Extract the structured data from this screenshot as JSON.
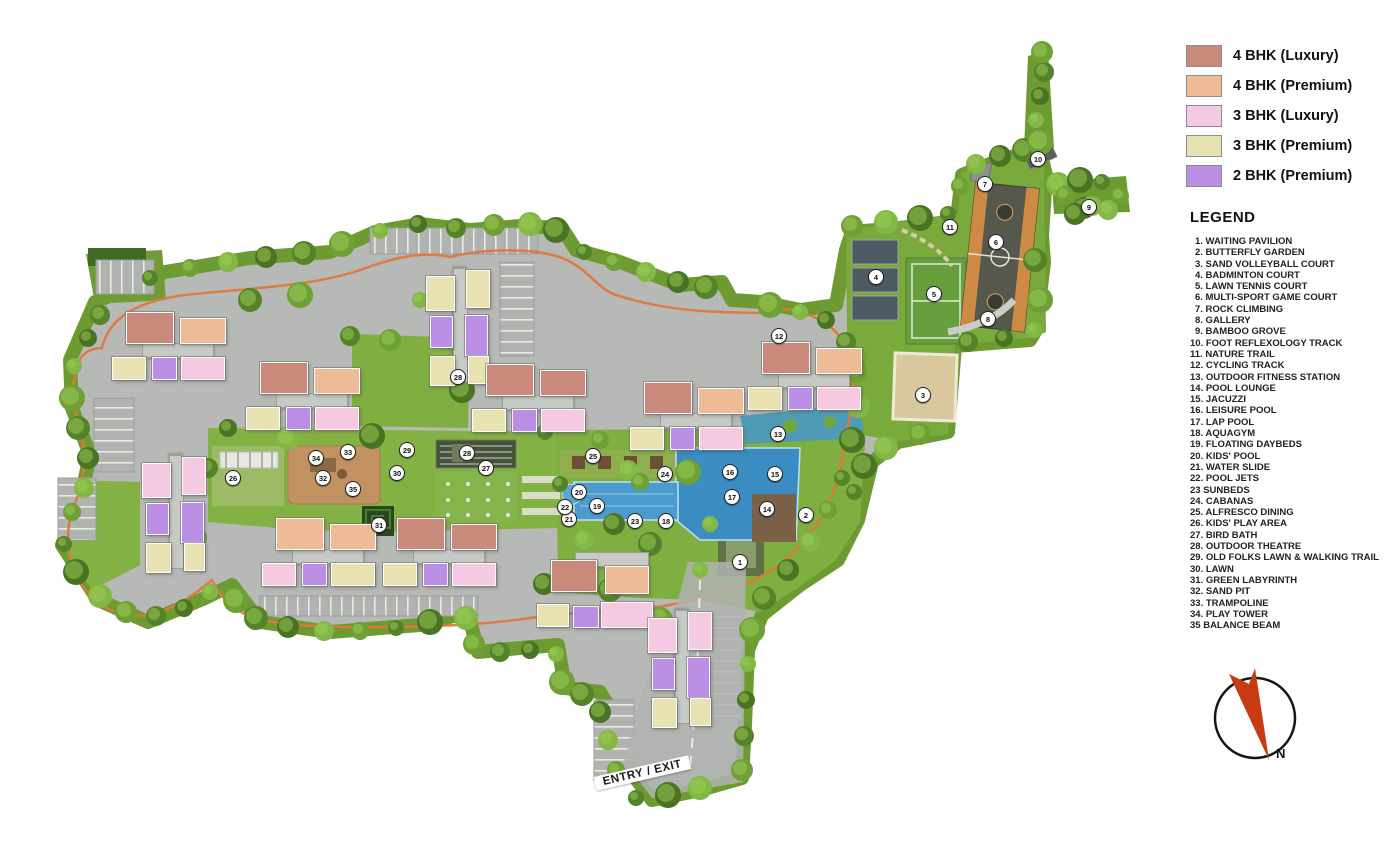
{
  "unit_legend": {
    "items": [
      {
        "label": "4 BHK (Luxury)",
        "color": "#c9897b"
      },
      {
        "label": "4 BHK (Premium)",
        "color": "#edbb95"
      },
      {
        "label": "3 BHK (Luxury)",
        "color": "#f4c9e1"
      },
      {
        "label": "3 BHK (Premium)",
        "color": "#e8e2b2"
      },
      {
        "label": "2 BHK (Premium)",
        "color": "#bb8fe5"
      }
    ]
  },
  "legend": {
    "title": "LEGEND",
    "items": [
      "1. WAITING PAVILION",
      "2. BUTTERFLY GARDEN",
      "3. SAND VOLLEYBALL COURT",
      "4. BADMINTON COURT",
      "5. LAWN TENNIS COURT",
      "6. MULTI-SPORT GAME COURT",
      "7. ROCK CLIMBING",
      "8. GALLERY",
      "9. BAMBOO GROVE",
      "10. FOOT REFLEXOLOGY TRACK",
      "11. NATURE TRAIL",
      "12. CYCLING TRACK",
      "13. OUTDOOR FITNESS STATION",
      "14. POOL LOUNGE",
      "15. JACUZZI",
      "16. LEISURE POOL",
      "17. LAP POOL",
      "18. AQUAGYM",
      "19. FLOATING DAYBEDS",
      "20. KIDS' POOL",
      "21. WATER SLIDE",
      "22. POOL JETS",
      "23 SUNBEDS",
      "24. CABANAS",
      "25. ALFRESCO DINING",
      "26. KIDS' PLAY AREA",
      "27. BIRD BATH",
      "28. OUTDOOR THEATRE",
      "29. OLD FOLKS LAWN & WALKING TRAIL",
      "30. LAWN",
      "31. GREEN LABYRINTH",
      "32. SAND PIT",
      "33. TRAMPOLINE",
      "34. PLAY TOWER",
      "35 BALANCE BEAM"
    ]
  },
  "compass": {
    "label": "N"
  },
  "entry_exit_label": "ENTRY / EXIT",
  "colors": {
    "road": "#b6b9b5",
    "lawn": "#84b143",
    "pool": "#3a8cc3",
    "trail": "#e0763c",
    "compass_arrow": "#c63c10"
  },
  "towers": [
    {
      "id": "tower-6",
      "name": "TOWER 6",
      "type": "h",
      "x": 112,
      "y": 312,
      "blocks": [
        {
          "letter": "A",
          "unit": "4 BHK (Luxury)"
        },
        {
          "letter": "B",
          "unit": "4 BHK (Premium)"
        },
        {
          "letter": "E",
          "unit": "3 BHK (Premium)"
        },
        {
          "letter": "D",
          "unit": "2 BHK (Premium)"
        },
        {
          "letter": "C",
          "unit": "3 BHK (Luxury)"
        }
      ]
    },
    {
      "id": "tower-7",
      "name": "TOWER 7",
      "type": "h",
      "x": 246,
      "y": 362,
      "blocks": [
        {
          "letter": "A",
          "unit": "4 BHK (Luxury)"
        },
        {
          "letter": "B",
          "unit": "4 BHK (Premium)"
        },
        {
          "letter": "E",
          "unit": "3 BHK (Premium)"
        },
        {
          "letter": "D",
          "unit": "2 BHK (Premium)"
        },
        {
          "letter": "C",
          "unit": "3 BHK (Luxury)"
        }
      ]
    },
    {
      "id": "tower-8",
      "name": "TOWER 8",
      "type": "v",
      "x": 426,
      "y": 268,
      "blocks": [
        {
          "letter": "F",
          "unit": "3 BHK (Premium)"
        },
        {
          "letter": "A",
          "unit": "3 BHK (Premium)"
        },
        {
          "letter": "E",
          "unit": "2 BHK (Premium)"
        },
        {
          "letter": "B",
          "unit": "2 BHK (Premium)"
        },
        {
          "letter": "D",
          "unit": "3 BHK (Premium)"
        },
        {
          "letter": "C",
          "unit": "3 BHK (Premium)"
        }
      ]
    },
    {
      "id": "tower-9",
      "name": "TOWER 9",
      "type": "h",
      "x": 472,
      "y": 364,
      "blocks": [
        {
          "letter": "A",
          "unit": "4 BHK (Luxury)"
        },
        {
          "letter": "B",
          "unit": "4 BHK (Luxury)"
        },
        {
          "letter": "E",
          "unit": "3 BHK (Premium)"
        },
        {
          "letter": "D",
          "unit": "2 BHK (Premium)"
        },
        {
          "letter": "C",
          "unit": "3 BHK (Luxury)"
        }
      ]
    },
    {
      "id": "tower-10",
      "name": "TOWER 10",
      "type": "h",
      "x": 630,
      "y": 382,
      "blocks": [
        {
          "letter": "A",
          "unit": "4 BHK (Luxury)"
        },
        {
          "letter": "B",
          "unit": "4 BHK (Premium)"
        },
        {
          "letter": "E",
          "unit": "3 BHK (Premium)"
        },
        {
          "letter": "D",
          "unit": "2 BHK (Premium)"
        },
        {
          "letter": "C",
          "unit": "3 BHK (Luxury)"
        }
      ]
    },
    {
      "id": "tower-11",
      "name": "TOWER 11",
      "type": "h",
      "x": 748,
      "y": 342,
      "blocks": [
        {
          "letter": "A",
          "unit": "4 BHK (Luxury)"
        },
        {
          "letter": "B",
          "unit": "4 BHK (Premium)"
        },
        {
          "letter": "E",
          "unit": "3 BHK (Premium)"
        },
        {
          "letter": "D",
          "unit": "2 BHK (Premium)"
        },
        {
          "letter": "C",
          "unit": "3 BHK (Luxury)"
        }
      ]
    },
    {
      "id": "tower-5",
      "name": "TOWER 5",
      "type": "v",
      "x": 142,
      "y": 455,
      "blocks": [
        {
          "letter": "F",
          "unit": "3 BHK (Luxury)"
        },
        {
          "letter": "A",
          "unit": "3 BHK (Luxury)"
        },
        {
          "letter": "E",
          "unit": "2 BHK (Premium)"
        },
        {
          "letter": "B",
          "unit": "2 BHK (Premium)"
        },
        {
          "letter": "D",
          "unit": "3 BHK (Premium)"
        },
        {
          "letter": "C",
          "unit": "3 BHK (Premium)"
        }
      ]
    },
    {
      "id": "tower-4",
      "name": "TOWER 4",
      "type": "h",
      "x": 262,
      "y": 518,
      "blocks": [
        {
          "letter": "A",
          "unit": "4 BHK (Premium)"
        },
        {
          "letter": "B",
          "unit": "4 BHK (Premium)"
        },
        {
          "letter": "E",
          "unit": "3 BHK (Luxury)"
        },
        {
          "letter": "D",
          "unit": "2 BHK (Premium)"
        },
        {
          "letter": "C",
          "unit": "3 BHK (Premium)"
        }
      ]
    },
    {
      "id": "tower-3",
      "name": "TOWER 3",
      "type": "h",
      "x": 383,
      "y": 518,
      "blocks": [
        {
          "letter": "A",
          "unit": "4 BHK (Luxury)"
        },
        {
          "letter": "B",
          "unit": "4 BHK (Luxury)"
        },
        {
          "letter": "E",
          "unit": "3 BHK (Premium)"
        },
        {
          "letter": "D",
          "unit": "2 BHK (Premium)"
        },
        {
          "letter": "C",
          "unit": "3 BHK (Luxury)"
        }
      ]
    },
    {
      "id": "tower-2",
      "name": "TOWER 2",
      "type": "ht",
      "x": 537,
      "y": 552,
      "blocks": [
        {
          "letter": "A",
          "unit": "4 BHK (Luxury)"
        },
        {
          "letter": "B",
          "unit": "4 BHK (Premium)"
        },
        {
          "letter": "E",
          "unit": "3 BHK (Premium)"
        },
        {
          "letter": "D",
          "unit": "2 BHK (Premium)"
        },
        {
          "letter": "C",
          "unit": "3 BHK (Luxury)"
        }
      ]
    },
    {
      "id": "tower-1",
      "name": "TOWER 1",
      "type": "v",
      "x": 648,
      "y": 610,
      "blocks": [
        {
          "letter": "F",
          "unit": "3 BHK (Luxury)"
        },
        {
          "letter": "A",
          "unit": "3 BHK (Luxury)"
        },
        {
          "letter": "E",
          "unit": "2 BHK (Premium)"
        },
        {
          "letter": "B",
          "unit": "2 BHK (Premium)"
        },
        {
          "letter": "D",
          "unit": "3 BHK (Premium)"
        },
        {
          "letter": "C",
          "unit": "3 BHK (Premium)"
        }
      ]
    }
  ],
  "markers": [
    {
      "n": "1",
      "x": 740,
      "y": 562
    },
    {
      "n": "2",
      "x": 806,
      "y": 515
    },
    {
      "n": "3",
      "x": 923,
      "y": 395
    },
    {
      "n": "4",
      "x": 876,
      "y": 277
    },
    {
      "n": "5",
      "x": 934,
      "y": 294
    },
    {
      "n": "6",
      "x": 996,
      "y": 242
    },
    {
      "n": "7",
      "x": 985,
      "y": 184
    },
    {
      "n": "8",
      "x": 988,
      "y": 319
    },
    {
      "n": "9",
      "x": 1089,
      "y": 207
    },
    {
      "n": "10",
      "x": 1038,
      "y": 159
    },
    {
      "n": "11",
      "x": 950,
      "y": 227
    },
    {
      "n": "12",
      "x": 779,
      "y": 336
    },
    {
      "n": "13",
      "x": 778,
      "y": 434
    },
    {
      "n": "14",
      "x": 767,
      "y": 509
    },
    {
      "n": "15",
      "x": 775,
      "y": 474
    },
    {
      "n": "16",
      "x": 730,
      "y": 472
    },
    {
      "n": "17",
      "x": 732,
      "y": 497
    },
    {
      "n": "18",
      "x": 666,
      "y": 521
    },
    {
      "n": "19",
      "x": 597,
      "y": 506
    },
    {
      "n": "20",
      "x": 579,
      "y": 492
    },
    {
      "n": "21",
      "x": 569,
      "y": 519
    },
    {
      "n": "22",
      "x": 565,
      "y": 507
    },
    {
      "n": "23",
      "x": 635,
      "y": 521
    },
    {
      "n": "24",
      "x": 665,
      "y": 474
    },
    {
      "n": "25",
      "x": 593,
      "y": 456
    },
    {
      "n": "26",
      "x": 233,
      "y": 478
    },
    {
      "n": "27",
      "x": 486,
      "y": 468
    },
    {
      "n": "28",
      "x": 467,
      "y": 453
    },
    {
      "n": "28",
      "x": 458,
      "y": 377
    },
    {
      "n": "29",
      "x": 407,
      "y": 450
    },
    {
      "n": "30",
      "x": 397,
      "y": 473
    },
    {
      "n": "31",
      "x": 379,
      "y": 525
    },
    {
      "n": "32",
      "x": 323,
      "y": 478
    },
    {
      "n": "33",
      "x": 348,
      "y": 452
    },
    {
      "n": "34",
      "x": 316,
      "y": 458
    },
    {
      "n": "35",
      "x": 353,
      "y": 489
    }
  ]
}
